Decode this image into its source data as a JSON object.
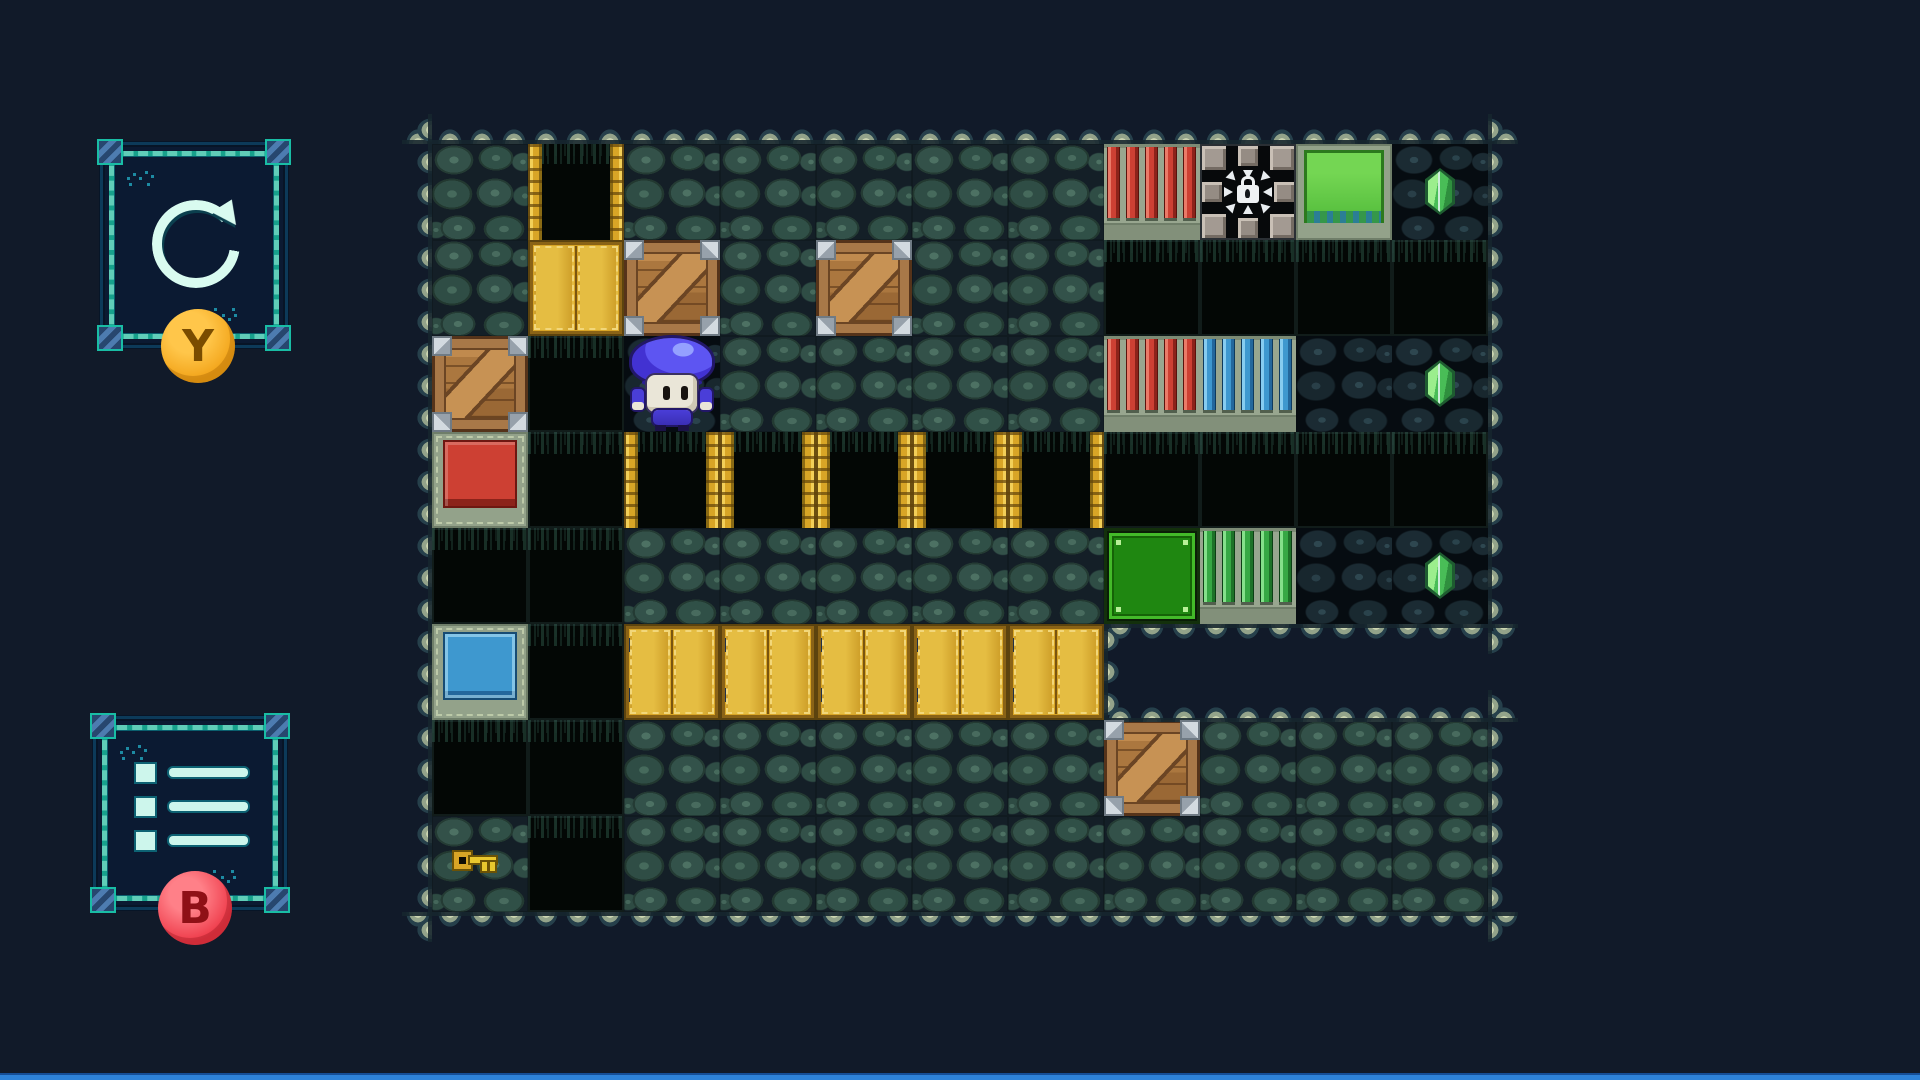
{
  "screen": {
    "width": 1920,
    "height": 1080
  },
  "hud": {
    "restart_button": {
      "badge": "Y",
      "icon": "circular-arrow-restart"
    },
    "menu_button": {
      "badge": "B",
      "icon": "list-menu"
    }
  },
  "level": {
    "tile_size": 96,
    "origin": {
      "x": 432,
      "y": 144
    },
    "grid": [
      [
        "S",
        "SH",
        "S",
        "S",
        "S",
        "S",
        "S",
        "RI",
        "LK",
        "JG",
        "DS"
      ],
      [
        "S",
        "YD",
        "CR",
        "S",
        "CR",
        "S",
        "S",
        "P",
        "P",
        "P",
        "P"
      ],
      [
        "CR",
        "P",
        "DS",
        "S",
        "S",
        "S",
        "S",
        "RI",
        "BI",
        "DS",
        "DS"
      ],
      [
        "RB",
        "P",
        "SH",
        "SH",
        "SH",
        "SH",
        "SH",
        "P",
        "P",
        "P",
        "P"
      ],
      [
        "P",
        "P",
        "S",
        "S",
        "S",
        "S",
        "S",
        "GB",
        "GI",
        "DS",
        "DS"
      ],
      [
        "BB",
        "P",
        "BR",
        "BR",
        "BR",
        "BR",
        "BR",
        "X",
        "X",
        "X",
        "X"
      ],
      [
        "P",
        "P",
        "S",
        "S",
        "S",
        "S",
        "S",
        "CR",
        "S",
        "S",
        "S"
      ],
      [
        "S",
        "P",
        "S",
        "S",
        "S",
        "S",
        "S",
        "S",
        "S",
        "S",
        "S"
      ]
    ],
    "legend": {
      "S": "stone-floor",
      "DS": "dark-stone-floor",
      "P": "pit",
      "SH": "gold-gate-shaft",
      "YD": "gold-door",
      "BR": "gold-bridge",
      "CR": "wooden-crate",
      "RB": "red-block",
      "BB": "blue-block",
      "GB": "green-block",
      "JG": "green-jelly-block",
      "RI": "red-bars",
      "BI": "blue-bars",
      "GI": "green-bars",
      "LK": "locked-vault",
      "X": "void"
    },
    "entities": [
      {
        "type": "player",
        "name": "player-mushroom",
        "row": 2,
        "col": 2
      },
      {
        "type": "key",
        "name": "key-item",
        "row": 7,
        "col": 0
      },
      {
        "type": "gem",
        "name": "gem-item",
        "row": 0,
        "col": 10
      },
      {
        "type": "gem",
        "name": "gem-item",
        "row": 2,
        "col": 10
      },
      {
        "type": "gem",
        "name": "gem-item",
        "row": 4,
        "col": 10
      }
    ]
  },
  "colors": {
    "red_block": "#cd4033",
    "blue_block": "#3e98cf",
    "green_block": "#1f8711",
    "gold": "#d8a526",
    "ui_teal": "#17a18c",
    "badge_y": "#f2a318",
    "badge_b": "#ee3948",
    "gem_green": "#49bd57",
    "bottom_bar": "#2e82d8"
  }
}
